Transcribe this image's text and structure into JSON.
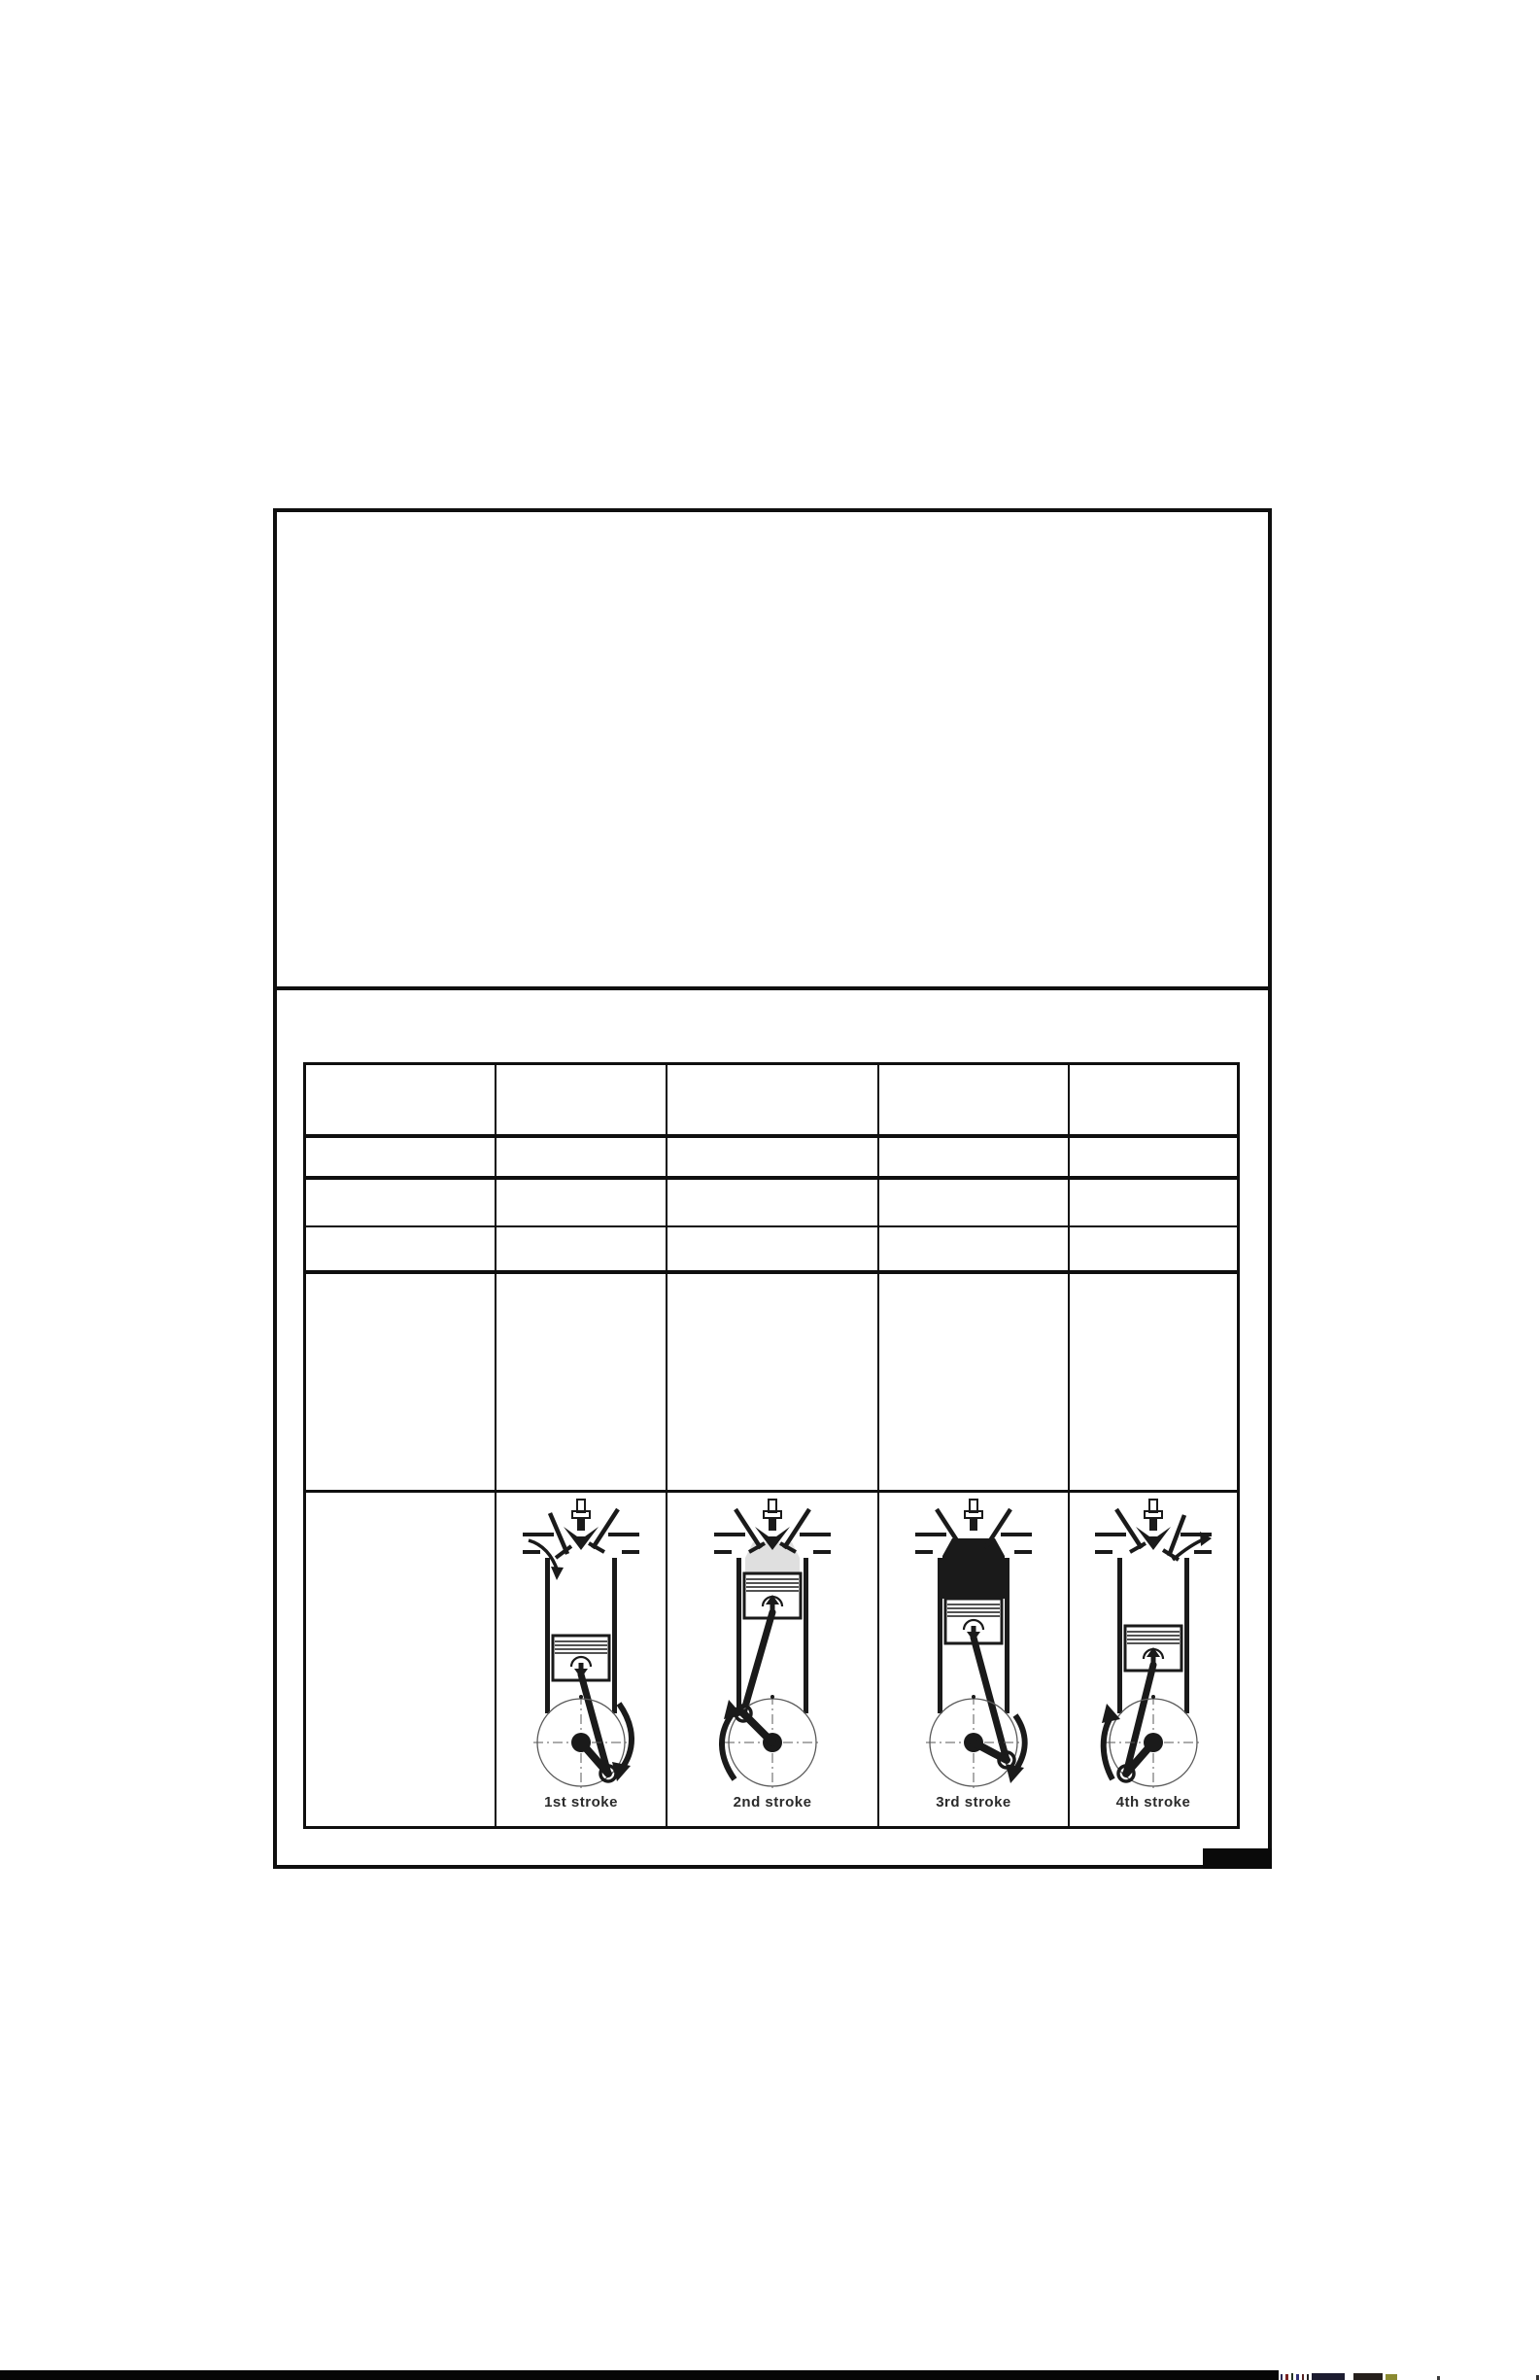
{
  "page": {
    "paper_color": "#ffffff",
    "ink_color": "#1a1a1a"
  },
  "table": {
    "rows": 6,
    "columns": 5
  },
  "strokes": [
    {
      "name": "intake",
      "label": "1st stroke"
    },
    {
      "name": "compression",
      "label": "2nd stroke"
    },
    {
      "name": "power",
      "label": "3rd stroke"
    },
    {
      "name": "exhaust",
      "label": "4th stroke"
    }
  ]
}
